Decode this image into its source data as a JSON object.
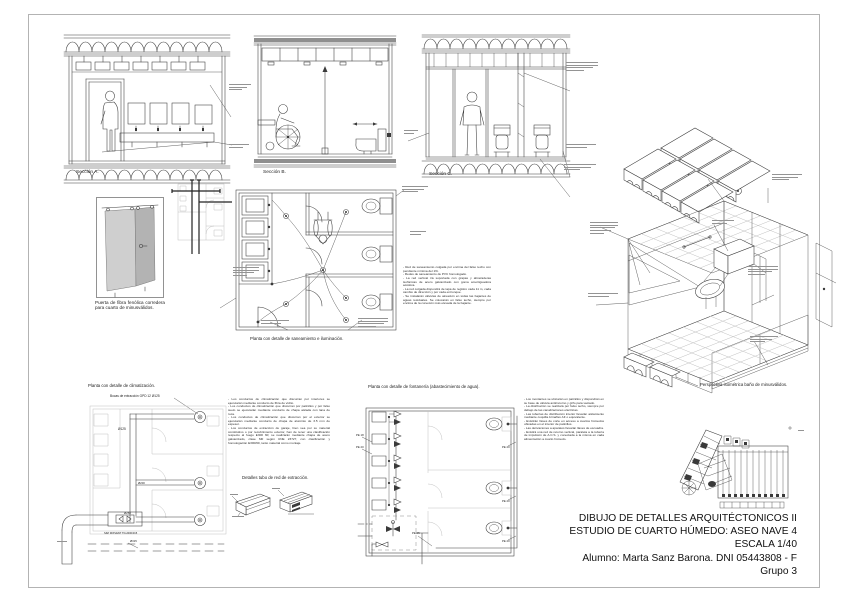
{
  "captions": {
    "section_a": "Sección A.",
    "section_b": "Sección B.",
    "section_c": "Sección C.",
    "door_detail": "Puerta de fibra fenólica corredera para cuarto de minusválidos.",
    "plan_sanitation": "Planta con detalle de saneamiento e iluminación.",
    "plan_hvac": "Planta con detalle de climatización.",
    "plan_plumbing": "Planta con detalle de fontanería (abastecimiento de agua).",
    "duct_detail": "Detalles tubo de red de extracción.",
    "isometric": "Perspectiva isométrica baño de minusválidos."
  },
  "labels": {
    "extraction_units": "Bocas de extracción GPD 12 Ø125",
    "fan_model": "S&P MIXVENT TD-2000/315",
    "d125": "Ø125",
    "d200": "Ø200",
    "d250": "Ø250",
    "d315": "Ø315",
    "pe18": "PE 18",
    "pe20": "PE 20",
    "pe25": "PE 25"
  },
  "notes": {
    "sanitation": "- Red de saneamiento colgada por encima del falso techo con pendiente mínima del 1%.\n- Redes de saneamiento de PVC homologado.\n- La red vertical irá soportada con grapas y abrazaderas isofónicas de acero galvanizado con goma amortiguadora acústica.\n- La red colgada dispondrá de tapa de registro cada 11 m, cada cambio de dirección y por cada entronque.\n- Se instalarán válvulas de aireación en todas las bajantes de aguas residuales. Se colocarán en falso techo, siempre por encima de la conexión más elevada de la bajante.",
    "hvac": "- Los conductos de climatización que discurran por interiores se ejecutarán mediante conducto de fibra de vidrio.\n- Los conductos de climatización que discurran por patinillos y por falso suelo se ejecutarán mediante conducto de chapa aislada con lana de roca.\n- Los conductos de climatización que discurran por el exterior se ejecutarán mediante conducto de chapa de aluminio de 3.5 mm de espesor.\n- Los conductos de extracción de garaje, bien sea por su material constitutivo o por recubrimiento exterior, han de tener una clasificación respecto al fuego E300 60; se realizarán mediante chapa de acero galvanizado, clase M0 según UNE 23727, con clasificación y homologación E300/60, tanto material como montaje.",
    "plumbing": "- Los montantes se ubicarán en patinillos y dispondrán en su base de válvula antirretorno y grifo para vaciado.\n- La distribución se realizará por falso techo, siempre por debajo de las canalizaciones eléctricas.\n- Las tuberías de distribución interior llevarán aislamiento mediante coquilla Armaflex AF o equivalente.\n- Existirán llaves de corte en acceso a cuartos húmedos ubicadas en el interior de patinillos.\n- Las derivaciones a aparatos llevarán llaves de escuadra.\n- Existirá una red de retorno vertical, paralela a la tubería de impulsión de A.C.S. y conectada a la misma en cada alimentación a cuarto húmedo."
  },
  "title_block": {
    "lines": [
      "DIBUJO DE DETALLES ARQUITÉCTONICOS II",
      "ESTUDIO DE CUARTO HÚMEDO: ASEO NAVE 4",
      "ESCALA 1/40",
      "Alumno: Marta Sanz Barona. DNI 05443808 - F",
      "Grupo 3"
    ]
  }
}
